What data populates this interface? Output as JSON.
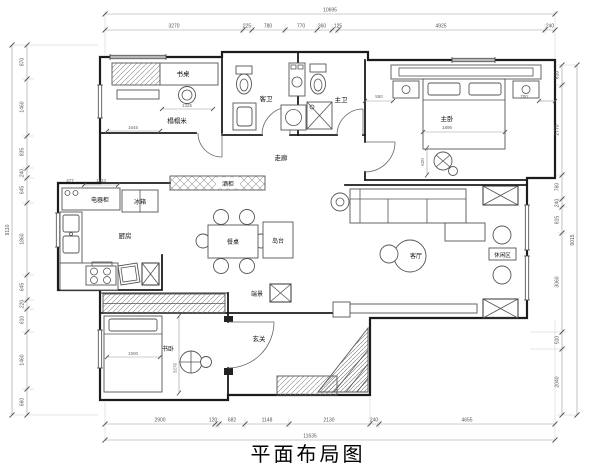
{
  "title": "平面布局图",
  "rooms": {
    "desk": "书桌",
    "tatami": "榻榻米",
    "guest_bath": "客卫",
    "master_bath": "主卫",
    "master_bed": "主卧",
    "corridor": "走廊",
    "wine_cabinet": "酒柜",
    "fridge": "冰箱",
    "appliance_cabinet": "电器柜",
    "kitchen": "厨房",
    "dining_table": "餐桌",
    "island": "岛台",
    "living": "客厅",
    "leisure": "休闲区",
    "endview": "端景",
    "study_bed": "书卧",
    "foyer": "玄关"
  },
  "dims": {
    "top": {
      "total": "10695",
      "segments": [
        "3270",
        "225",
        "780",
        "770",
        "360",
        "125",
        "4925",
        "240"
      ]
    },
    "bottom": {
      "total": "11635",
      "segments": [
        "2900",
        "120",
        "682",
        "1148",
        "2130",
        "240",
        "4655"
      ]
    },
    "left": {
      "total": "9110",
      "segments": [
        "870",
        "1460",
        "835",
        "240",
        "645",
        "1860",
        "645",
        "220",
        "610",
        "1460",
        "660"
      ]
    },
    "right": {
      "total": "9015",
      "segments": [
        "610",
        "2770",
        "760",
        "240",
        "815",
        "3060",
        "510",
        "2040"
      ]
    },
    "interior": {
      "desk_width": "1325",
      "tatami_width": "1645",
      "appliance_top": "1133",
      "appliance_left": "477",
      "bed_left": "550",
      "bed_right": "700",
      "master_bed_width": "1896",
      "bedroom_chair": "620",
      "study_bed_width": "1500",
      "study_bed_length": "3276"
    }
  }
}
